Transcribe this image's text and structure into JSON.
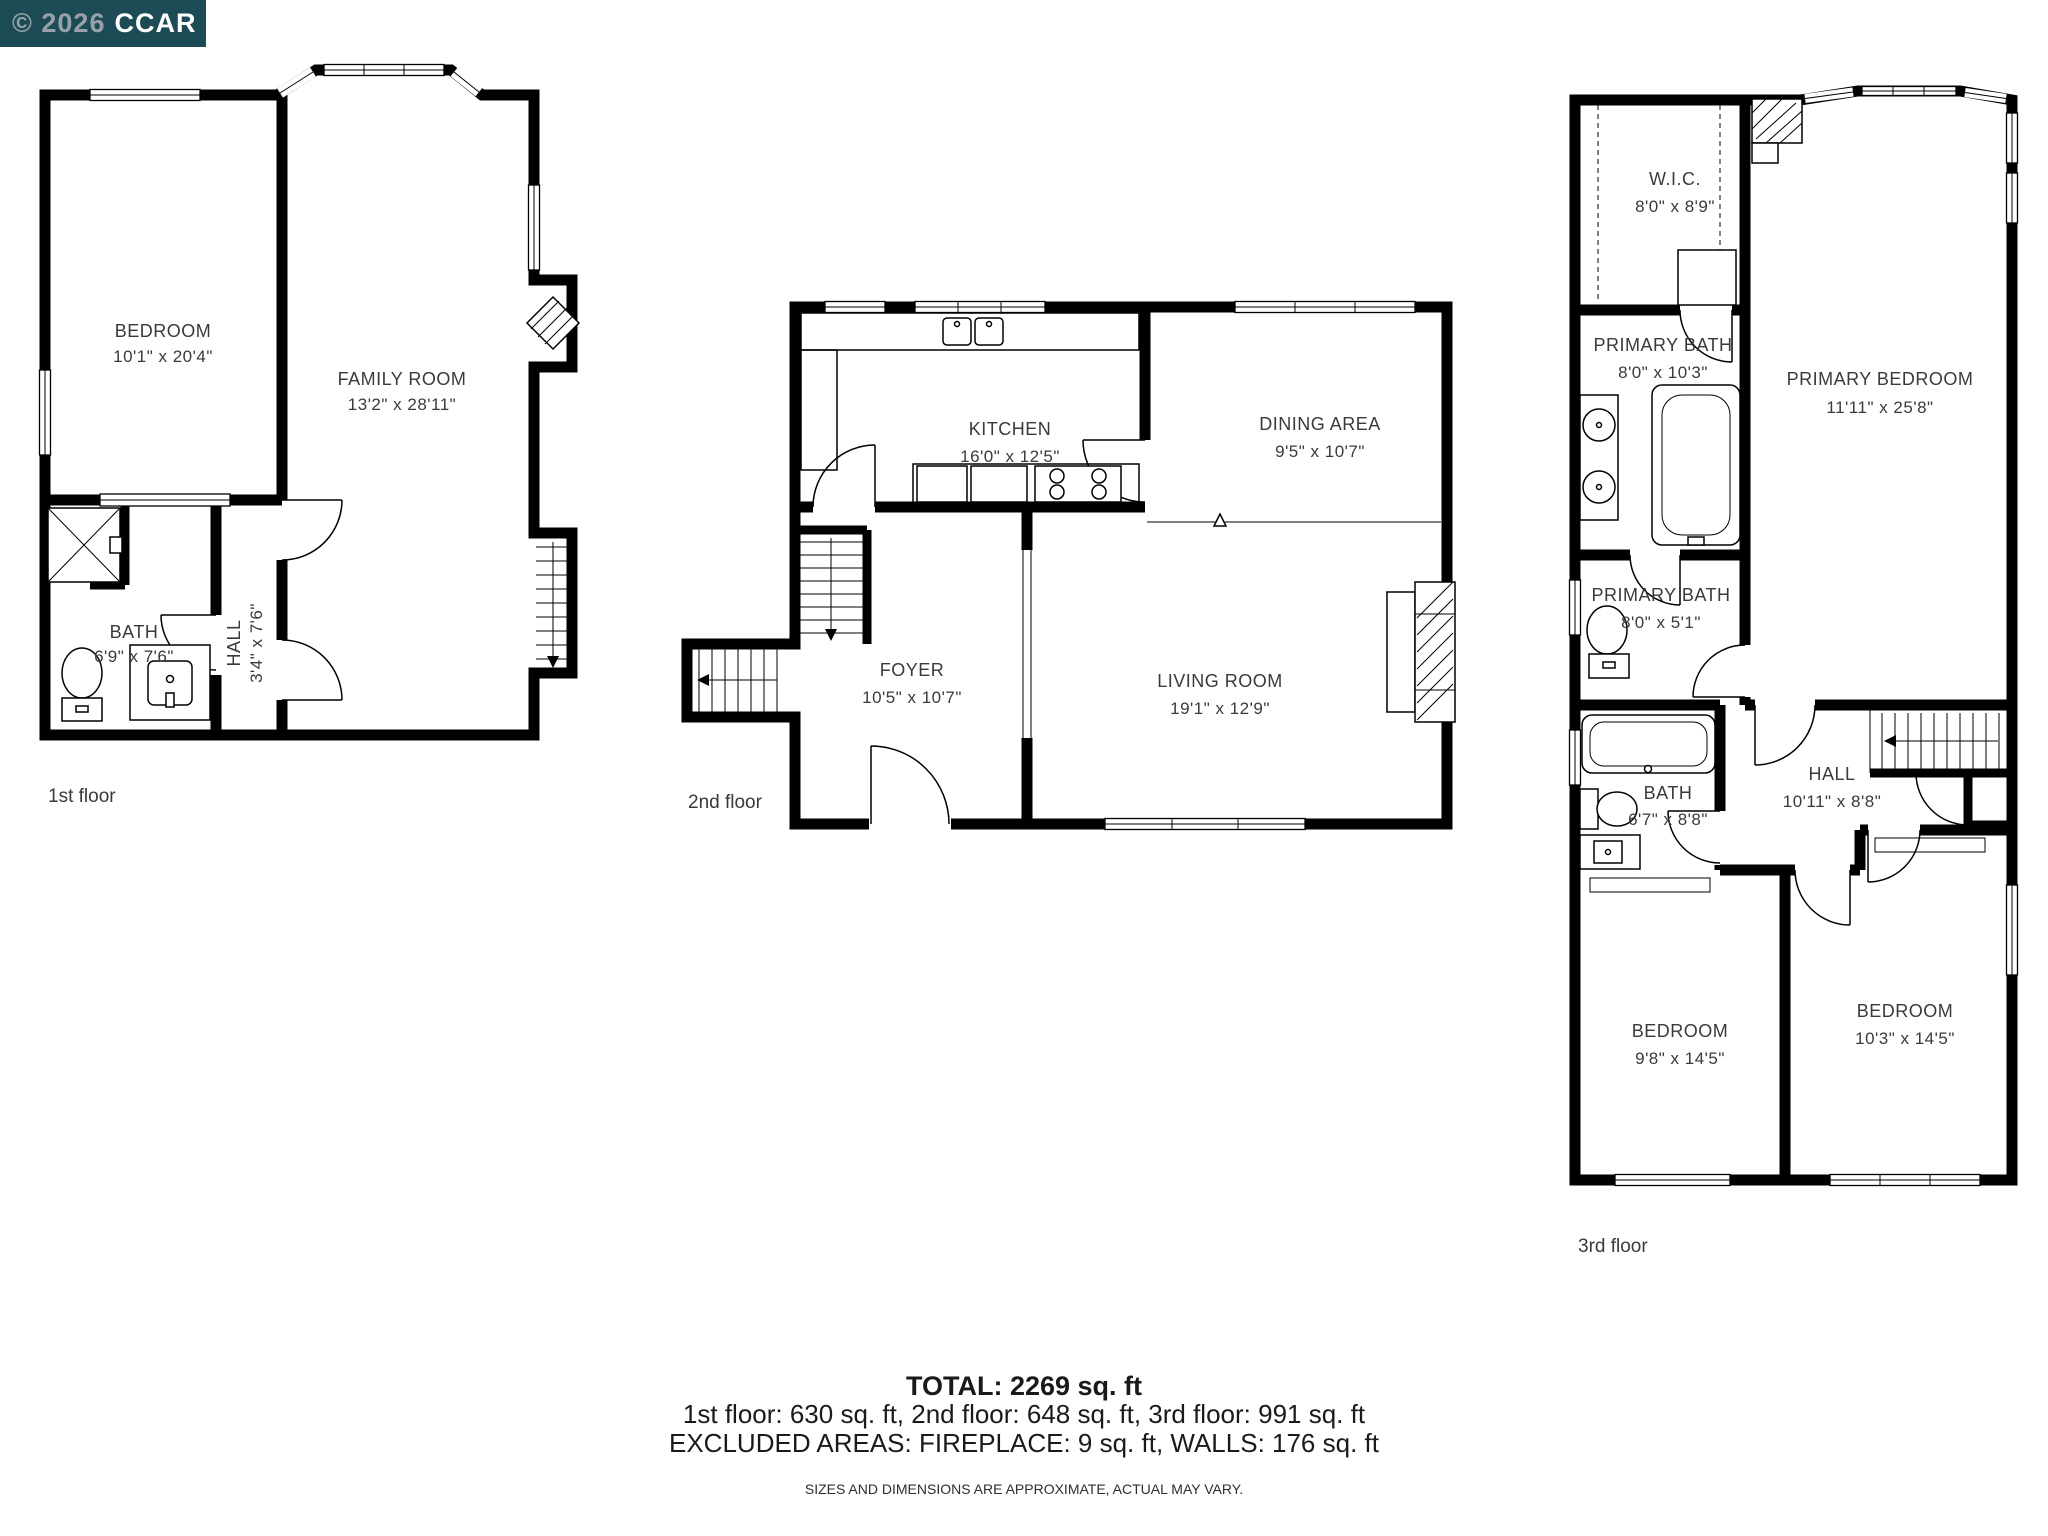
{
  "watermark": {
    "copyright": "© 2026",
    "brand": "CCAR",
    "bg_color": "#1c4b55",
    "copyright_color": "#97a2a8",
    "brand_color": "#ffffff"
  },
  "plan_colors": {
    "wall": "#000000",
    "label": "#3a3a3a",
    "background": "#ffffff"
  },
  "floors": [
    {
      "label": "1st floor",
      "rooms": [
        {
          "name": "BEDROOM",
          "dims": "10'1\" x 20'4\""
        },
        {
          "name": "FAMILY ROOM",
          "dims": "13'2\" x 28'11\""
        },
        {
          "name": "BATH",
          "dims": "6'9\" x 7'6\""
        },
        {
          "name": "HALL",
          "dims": "3'4\" x 7'6\""
        }
      ]
    },
    {
      "label": "2nd floor",
      "rooms": [
        {
          "name": "KITCHEN",
          "dims": "16'0\" x 12'5\""
        },
        {
          "name": "DINING AREA",
          "dims": "9'5\" x 10'7\""
        },
        {
          "name": "FOYER",
          "dims": "10'5\" x 10'7\""
        },
        {
          "name": "LIVING ROOM",
          "dims": "19'1\" x 12'9\""
        }
      ]
    },
    {
      "label": "3rd floor",
      "rooms": [
        {
          "name": "W.I.C.",
          "dims": "8'0\" x 8'9\""
        },
        {
          "name": "PRIMARY BATH",
          "dims": "8'0\" x 10'3\""
        },
        {
          "name": "PRIMARY BEDROOM",
          "dims": "11'11\" x 25'8\""
        },
        {
          "name": "PRIMARY BATH",
          "dims": "8'0\" x 5'1\""
        },
        {
          "name": "BATH",
          "dims": "6'7\" x 8'8\""
        },
        {
          "name": "HALL",
          "dims": "10'11\" x 8'8\""
        },
        {
          "name": "BEDROOM",
          "dims": "9'8\" x 14'5\""
        },
        {
          "name": "BEDROOM",
          "dims": "10'3\" x 14'5\""
        }
      ]
    }
  ],
  "summary": {
    "total": "TOTAL: 2269 sq. ft",
    "breakdown": "1st floor: 630 sq. ft, 2nd floor: 648 sq. ft, 3rd floor: 991 sq. ft",
    "excluded": "EXCLUDED AREAS: FIREPLACE: 9 sq. ft, WALLS: 176 sq. ft",
    "disclaimer": "SIZES AND DIMENSIONS ARE APPROXIMATE, ACTUAL MAY VARY."
  }
}
